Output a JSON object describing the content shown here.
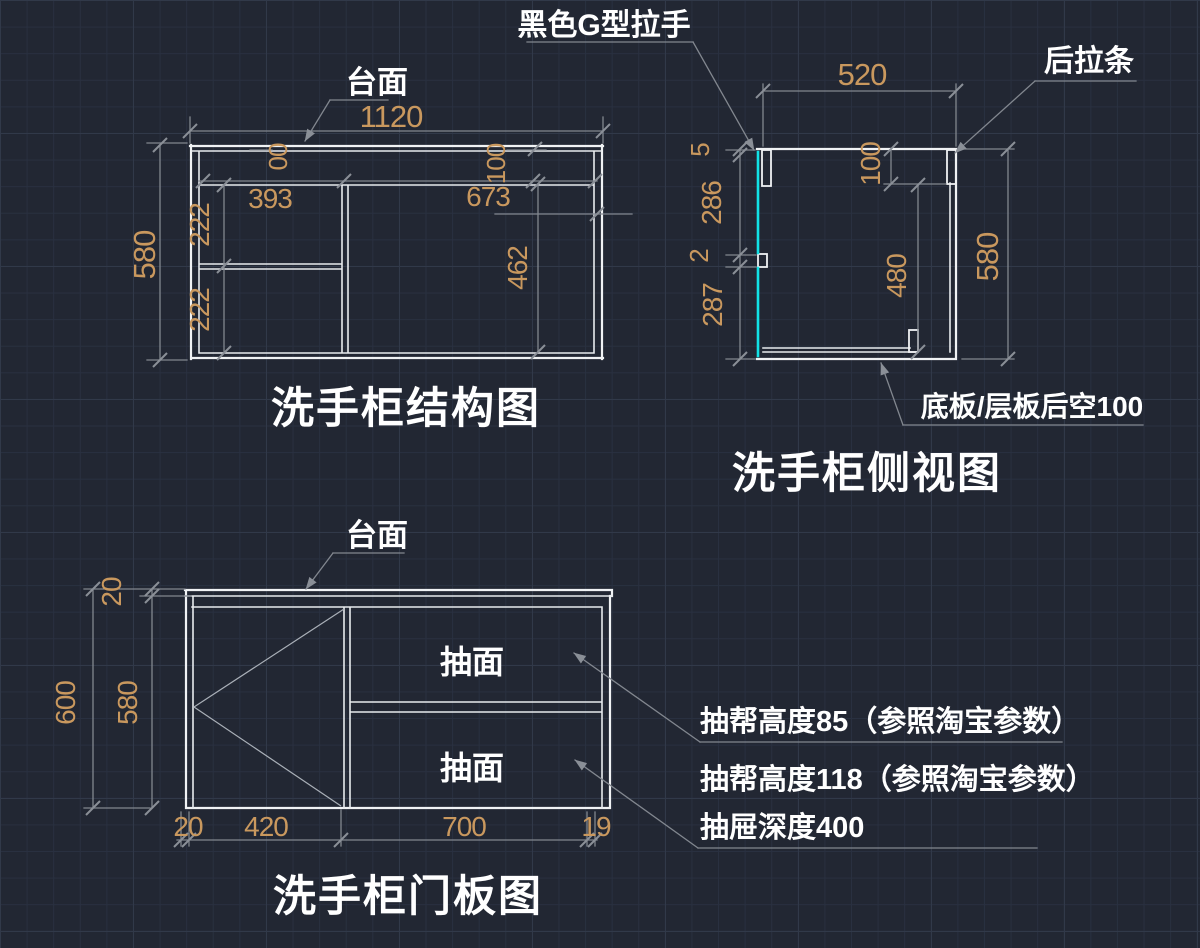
{
  "colors": {
    "background": "#222733",
    "grid_minor": "#293040",
    "grid_major": "#313949",
    "drawing_line": "#f0f2f4",
    "dimension_line": "#82878f",
    "dimension_text": "#c9985e",
    "label_text": "#ffffff",
    "handle_accent": "#12e2e6"
  },
  "structure_view": {
    "title": "洗手柜结构图",
    "countertop_label": "台面",
    "dim_total_width": "1120",
    "dim_total_height": "580",
    "dim_left_section": "393",
    "dim_right_section": "673",
    "dim_left_rail": "00",
    "dim_right_rail": "100",
    "dim_shelf_upper": "222",
    "dim_shelf_lower": "222",
    "dim_right_inner": "462"
  },
  "side_view": {
    "title": "洗手柜侧视图",
    "handle_label": "黑色G型拉手",
    "rear_rail_label": "后拉条",
    "bottom_note": "底板/层板后空100",
    "dim_depth": "520",
    "dim_top_gap": "5",
    "dim_upper_front": "286",
    "dim_mid_gap": "2",
    "dim_lower_front": "287",
    "dim_rear_rail": "100",
    "dim_inner_height": "480",
    "dim_total_height": "580"
  },
  "door_view": {
    "title": "洗手柜门板图",
    "countertop_label": "台面",
    "drawer_label_upper": "抽面",
    "drawer_label_lower": "抽面",
    "note_1": "抽帮高度85（参照淘宝参数）",
    "note_2": "抽帮高度118（参照淘宝参数）",
    "note_3": "抽屉深度400",
    "dim_countertop": "20",
    "dim_total_height": "600",
    "dim_body_height": "580",
    "dim_left_gap": "20",
    "dim_door_width": "420",
    "dim_drawer_width": "700",
    "dim_right_gap": "19"
  }
}
